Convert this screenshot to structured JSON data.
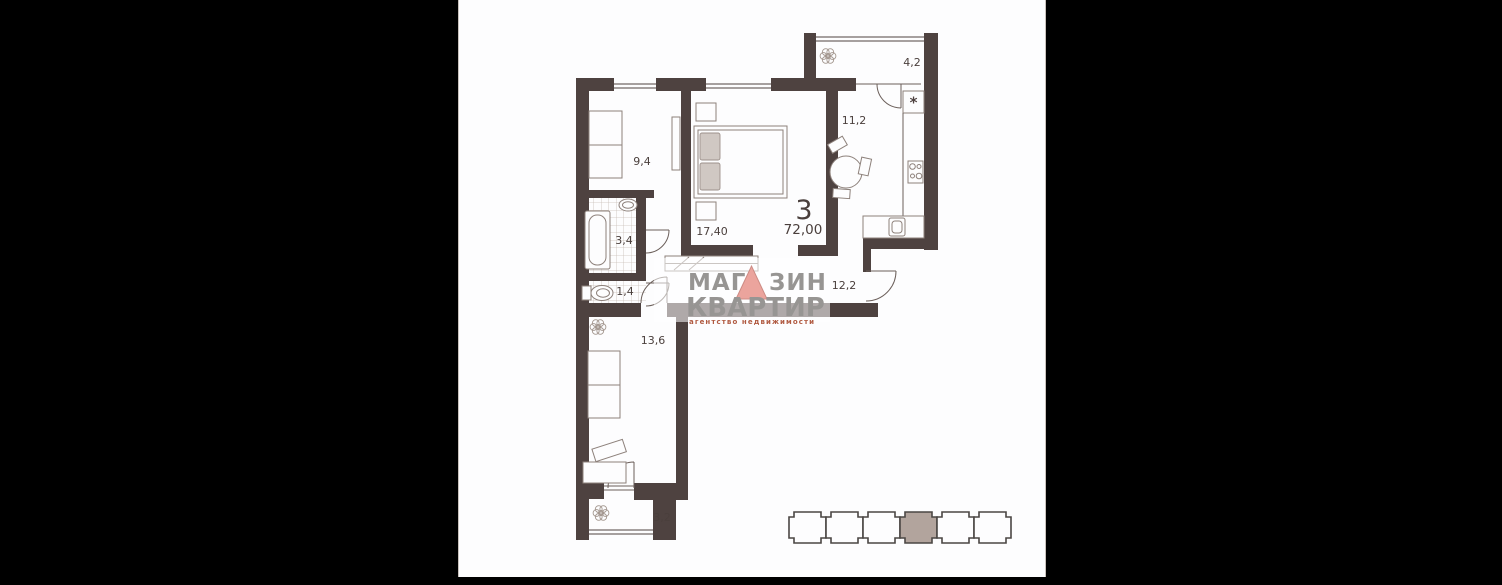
{
  "page": {
    "background": "#000000",
    "panel_background": "#fdfdfe"
  },
  "plan": {
    "type_number": "3",
    "total_area": "72,00",
    "fridge_symbol": "*",
    "rooms": {
      "living_9_4": {
        "label": "9,4"
      },
      "bedroom_17_40": {
        "label": "17,40"
      },
      "kitchen_11_2": {
        "label": "11,2"
      },
      "loggia_4_2": {
        "label": "4,2"
      },
      "bath_3_4": {
        "label": "3,4"
      },
      "wc_1_4": {
        "label": "1,4"
      },
      "hall_12_2": {
        "label": "12,2"
      },
      "room_13_6": {
        "label": "13,6"
      },
      "loggia_3_2": {
        "label": "3,2"
      }
    },
    "colors": {
      "wall": "#4e4240",
      "label": "#4a3f3c",
      "furniture_line": "#8d817b",
      "pillow": "#d0c8c3",
      "tile_line": "#c9beb8"
    }
  },
  "watermark": {
    "line1_left": "МАГ",
    "line1_right": "ЗИН",
    "line2": "КВАРТИР",
    "line3": "агентство недвижимости",
    "text_color": "#979593",
    "triangle_color": "#eba49d",
    "subtext_color": "#b05a41"
  },
  "building_indicator": {
    "sections": 6,
    "highlighted_section": 4,
    "highlight_color": "#b2a49d",
    "outline_color": "#4b4744"
  }
}
